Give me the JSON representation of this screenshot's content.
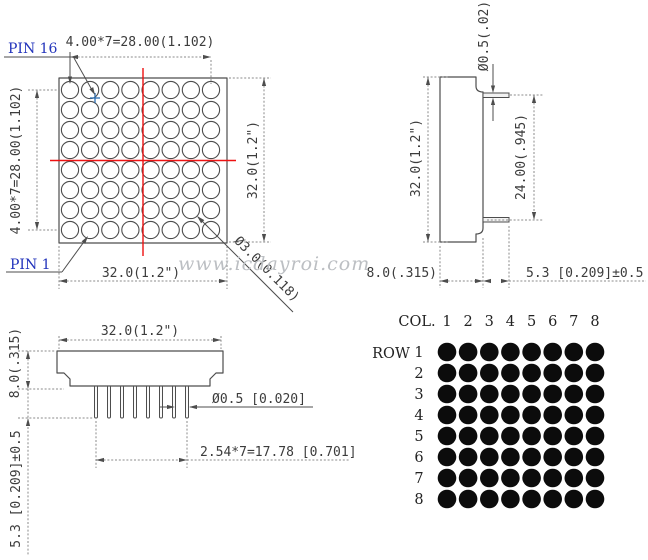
{
  "watermark": {
    "text": "www.icdayroi.com"
  },
  "front_view": {
    "pin16_label": "PIN 16",
    "pin1_label": "PIN 1",
    "dim_col_pitch": "4.00*7=28.00(1.102)",
    "dim_row_pitch": "4.00*7=28.00(1.102)",
    "dim_width": "32.0(1.2\")",
    "dim_height": "32.0(1.2\")",
    "dim_dot_diameter": "Ø3.0(0.118)",
    "rows": 8,
    "cols": 8
  },
  "side_view": {
    "dim_height": "32.0(1.2\")",
    "dim_lead_thickness": "Ø0.5(.02)",
    "dim_lead_span": "24.00(.945)",
    "dim_depth": "8.0(.315)",
    "dim_lead_protrusion": "5.3 [0.209]±0.5"
  },
  "bottom_view": {
    "dim_width": "32.0(1.2\")",
    "dim_depth": "8.0(.315)",
    "dim_lead_length": "5.3 [0.209]±0.5",
    "dim_lead_diameter": "Ø0.5 [0.020]",
    "dim_lead_pitch": "2.54*7=17.78 [0.701]",
    "pins": 8
  },
  "matrix_diagram": {
    "col_label": "COL.",
    "row_label": "ROW",
    "col_numbers": [
      "1",
      "2",
      "3",
      "4",
      "5",
      "6",
      "7",
      "8"
    ],
    "row_numbers": [
      "1",
      "2",
      "3",
      "4",
      "5",
      "6",
      "7",
      "8"
    ],
    "rows": 8,
    "cols": 8
  },
  "colors": {
    "line": "#4d4d4d",
    "dimension_line": "#8b8b8b",
    "text": "#3c3c3c",
    "crosshair_red": "#ee1111",
    "pin_label_blue": "#2233bb",
    "datum_marker_blue": "#2b6cb0",
    "watermark_gray": "#bcbfc3",
    "dot_black": "#0c0c0c",
    "background": "#ffffff"
  }
}
